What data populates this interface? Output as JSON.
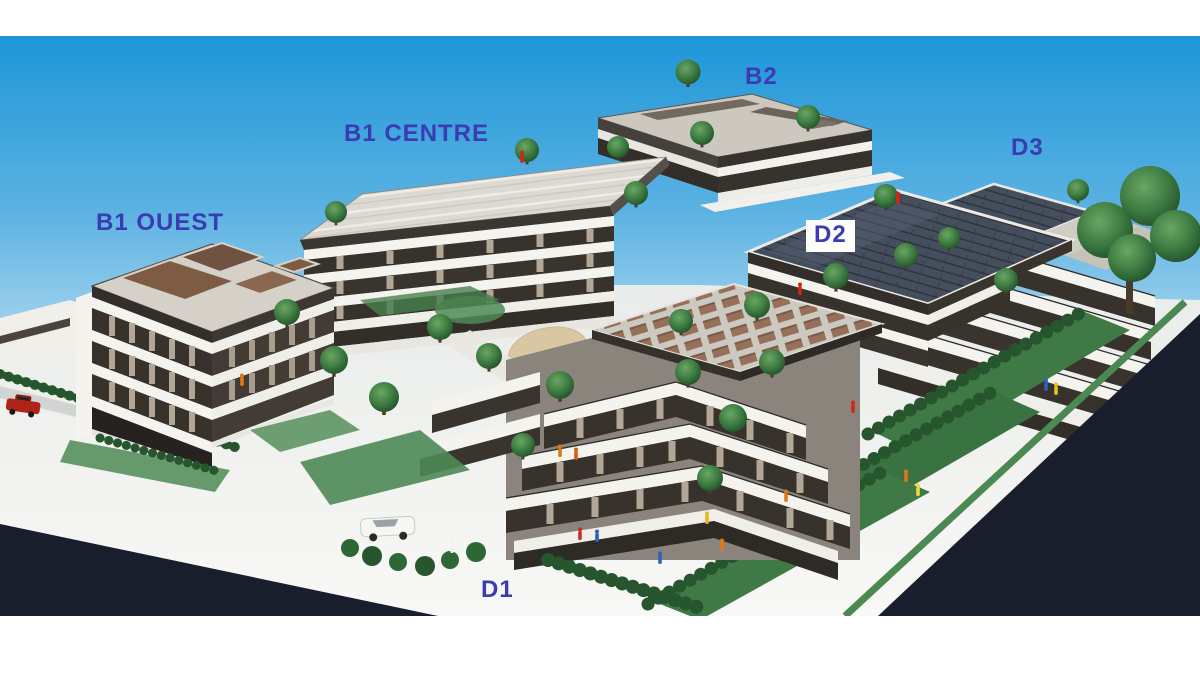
{
  "scene": {
    "type": "architectural-model-photo",
    "description": "Aerial photograph of a white architectural scale model of a residential complex: six labeled terraced apartment buildings, miniature trees, hedges, lawns, tiny figurines and cars, dark roads along two edges, under a blue gradient sky.",
    "labels": [
      {
        "id": "b1-ouest",
        "text": "B1 OUEST"
      },
      {
        "id": "b1-centre",
        "text": "B1 CENTRE"
      },
      {
        "id": "b2",
        "text": "B2"
      },
      {
        "id": "d3",
        "text": "D3"
      },
      {
        "id": "d2",
        "text": "D2"
      },
      {
        "id": "d1",
        "text": "D1"
      }
    ],
    "colors": {
      "label_text": "#3b3bb2",
      "label_box_bg": "#fdfdfa",
      "page_bg": "#ffffff",
      "sky_top": "#1e96d8",
      "road_dark": "#191e2c",
      "ground_light": "#f1f2ef",
      "building_white": "#f4f3ee",
      "window_dark": "#38322c",
      "wall_beige": "#b2a797",
      "roof_grey": "#d5d1c8",
      "roof_brown": "#7d5c43",
      "solar_dark": "#454e5c",
      "tree_green": "#2c5e31",
      "lawn_green": "#3f7a46",
      "sand_tan": "#d9c7a3",
      "car_red": "#b02418",
      "car_white": "#f6f6f3"
    }
  }
}
